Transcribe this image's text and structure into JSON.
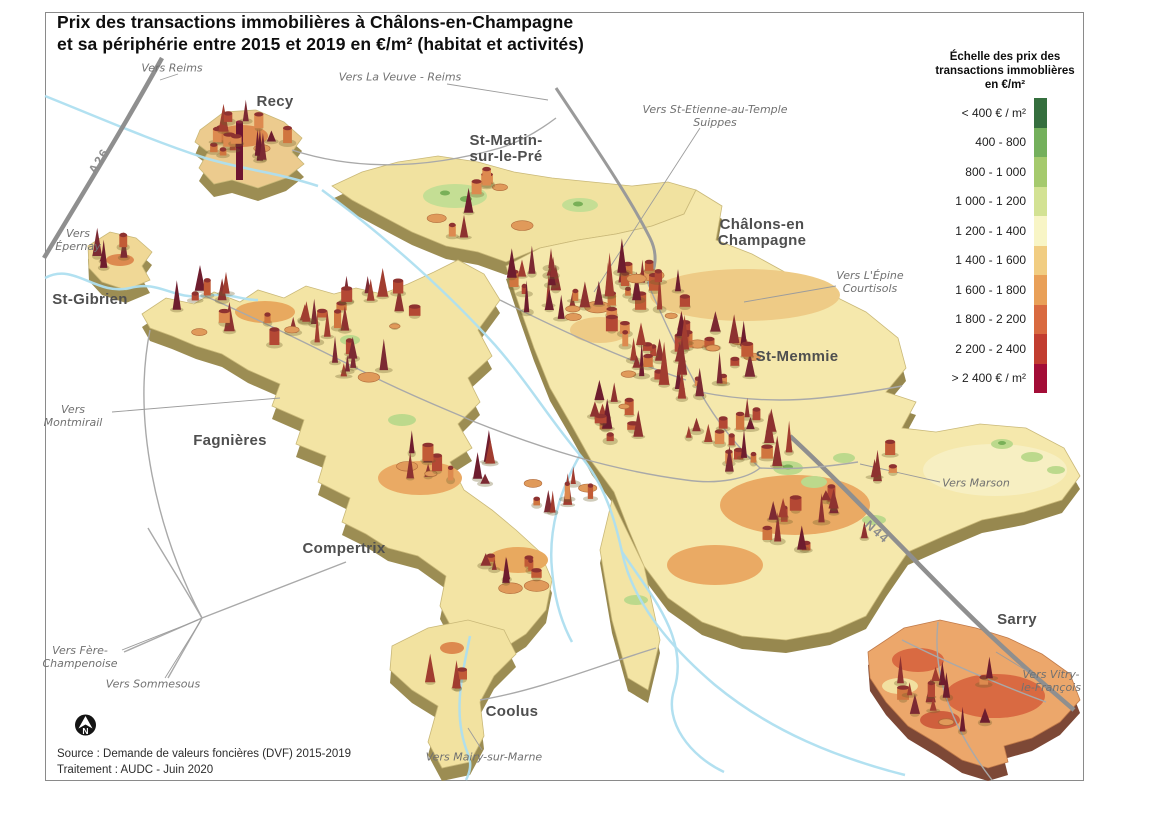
{
  "title": {
    "text": "Prix des transactions immobilières à Châlons-en-Champagne\net sa périphérie entre 2015 et 2019 en €/m² (habitat et activités)"
  },
  "legend": {
    "title": "Échelle des prix des\ntransactions immoblières\nen €/m²",
    "items": [
      {
        "label": "< 400 € / m²",
        "color": "#356f3e"
      },
      {
        "label": "400 - 800",
        "color": "#74b05c"
      },
      {
        "label": "800 - 1 000",
        "color": "#a5ca6d"
      },
      {
        "label": "1 000 - 1 200",
        "color": "#d3e293"
      },
      {
        "label": "1 200 - 1 400",
        "color": "#f8f5c6"
      },
      {
        "label": "1 400 - 1 600",
        "color": "#f1cd82"
      },
      {
        "label": "1 600 - 1 800",
        "color": "#e9a058"
      },
      {
        "label": "1 800 - 2 200",
        "color": "#d96a40"
      },
      {
        "label": "2 200 - 2 400",
        "color": "#c23d30"
      },
      {
        "label": "> 2 400 € / m²",
        "color": "#a30d37"
      }
    ]
  },
  "map": {
    "labels": [
      {
        "type": "city",
        "text": "Recy",
        "x": 275,
        "y": 102
      },
      {
        "type": "city",
        "text": "St-Martin-\nsur-le-Pré",
        "x": 506,
        "y": 149
      },
      {
        "type": "city",
        "text": "Châlons-en\nChampagne",
        "x": 762,
        "y": 233
      },
      {
        "type": "city",
        "text": "St-Gibrien",
        "x": 90,
        "y": 300
      },
      {
        "type": "city",
        "text": "St-Memmie",
        "x": 797,
        "y": 357
      },
      {
        "type": "city",
        "text": "Fagnières",
        "x": 230,
        "y": 441
      },
      {
        "type": "city",
        "text": "Compertrix",
        "x": 344,
        "y": 549
      },
      {
        "type": "city",
        "text": "Coolus",
        "x": 512,
        "y": 712
      },
      {
        "type": "city",
        "text": "Sarry",
        "x": 1017,
        "y": 620
      },
      {
        "type": "direction",
        "text": "Vers Reims",
        "x": 172,
        "y": 68
      },
      {
        "type": "direction",
        "text": "Vers La Veuve - Reims",
        "x": 400,
        "y": 77
      },
      {
        "type": "direction",
        "text": "Vers St-Etienne-au-Temple\nSuippes",
        "x": 715,
        "y": 116
      },
      {
        "type": "direction",
        "text": "Vers\nÉpernay",
        "x": 78,
        "y": 240
      },
      {
        "type": "direction",
        "text": "Vers L'Épine\nCourtisols",
        "x": 870,
        "y": 282
      },
      {
        "type": "direction",
        "text": "Vers\nMontmirail",
        "x": 73,
        "y": 416
      },
      {
        "type": "direction",
        "text": "Vers Marson",
        "x": 976,
        "y": 483
      },
      {
        "type": "direction",
        "text": "Vers Fère-\nChampenoise",
        "x": 80,
        "y": 657
      },
      {
        "type": "direction",
        "text": "Vers Sommesous",
        "x": 153,
        "y": 684
      },
      {
        "type": "direction",
        "text": "Vers Mairy-sur-Marne",
        "x": 484,
        "y": 757
      },
      {
        "type": "direction",
        "text": "Vers Vitry-\nle-François",
        "x": 1051,
        "y": 681
      },
      {
        "type": "road",
        "text": "A26",
        "x": 99,
        "y": 161,
        "rotate": -58
      },
      {
        "type": "road",
        "text": "N44",
        "x": 877,
        "y": 532,
        "rotate": 41
      }
    ],
    "north_icon": "north-arrow"
  },
  "footer": {
    "text": "Source : Demande de valeurs foncières (DVF) 2015-2019\nTraitement : AUDC - Juin 2020"
  }
}
